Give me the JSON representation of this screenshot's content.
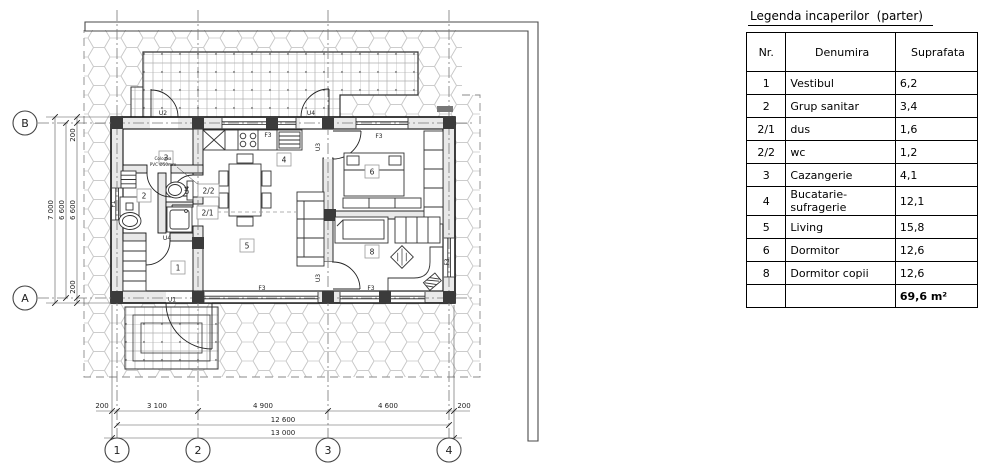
{
  "legend": {
    "title": "Legenda incaperilor  (parter)",
    "headers": {
      "nr": "Nr.",
      "name": "Denumira",
      "area": "Suprafata"
    },
    "rows": [
      {
        "nr": "1",
        "name": "Vestibul",
        "area": "6,2"
      },
      {
        "nr": "2",
        "name": "Grup sanitar",
        "area": "3,4"
      },
      {
        "nr": "2/1",
        "name": "dus",
        "area": "1,6"
      },
      {
        "nr": "2/2",
        "name": "wc",
        "area": "1,2"
      },
      {
        "nr": "3",
        "name": "Cazangerie",
        "area": "4,1"
      },
      {
        "nr": "4",
        "name": "Bucatarie-sufragerie",
        "area": "12,1"
      },
      {
        "nr": "5",
        "name": "Living",
        "area": "15,8"
      },
      {
        "nr": "6",
        "name": "Dormitor",
        "area": "12,6"
      },
      {
        "nr": "8",
        "name": "Dormitor copii",
        "area": "12,6"
      }
    ],
    "total": "69,6 m²"
  },
  "plan": {
    "grid_cols": {
      "c1": "1",
      "c2": "2",
      "c3": "3",
      "c4": "4"
    },
    "grid_rows": {
      "rA": "A",
      "rB": "B"
    },
    "dims": {
      "b200l": "200",
      "b3100": "3 100",
      "b4900": "4 900",
      "b4600": "4 600",
      "b200r": "200",
      "b12600": "12 600",
      "b13000": "13 000",
      "l200t": "200",
      "l6600": "6 600",
      "l200b": "200",
      "l6600b": "6 600",
      "l7000": "7 000"
    },
    "rooms": {
      "r1": "1",
      "r2": "2",
      "r21": "2/1",
      "r22": "2/2",
      "r3": "3",
      "r4": "4",
      "r5": "5",
      "r6": "6",
      "r8": "8"
    },
    "labels": {
      "u1": "U1",
      "u2": "U2",
      "u3": "U3",
      "u4": "U4",
      "f1": "F1",
      "f3": "F3"
    },
    "note_line1": "Coloana",
    "note_line2": "PVC Ø50mm"
  }
}
